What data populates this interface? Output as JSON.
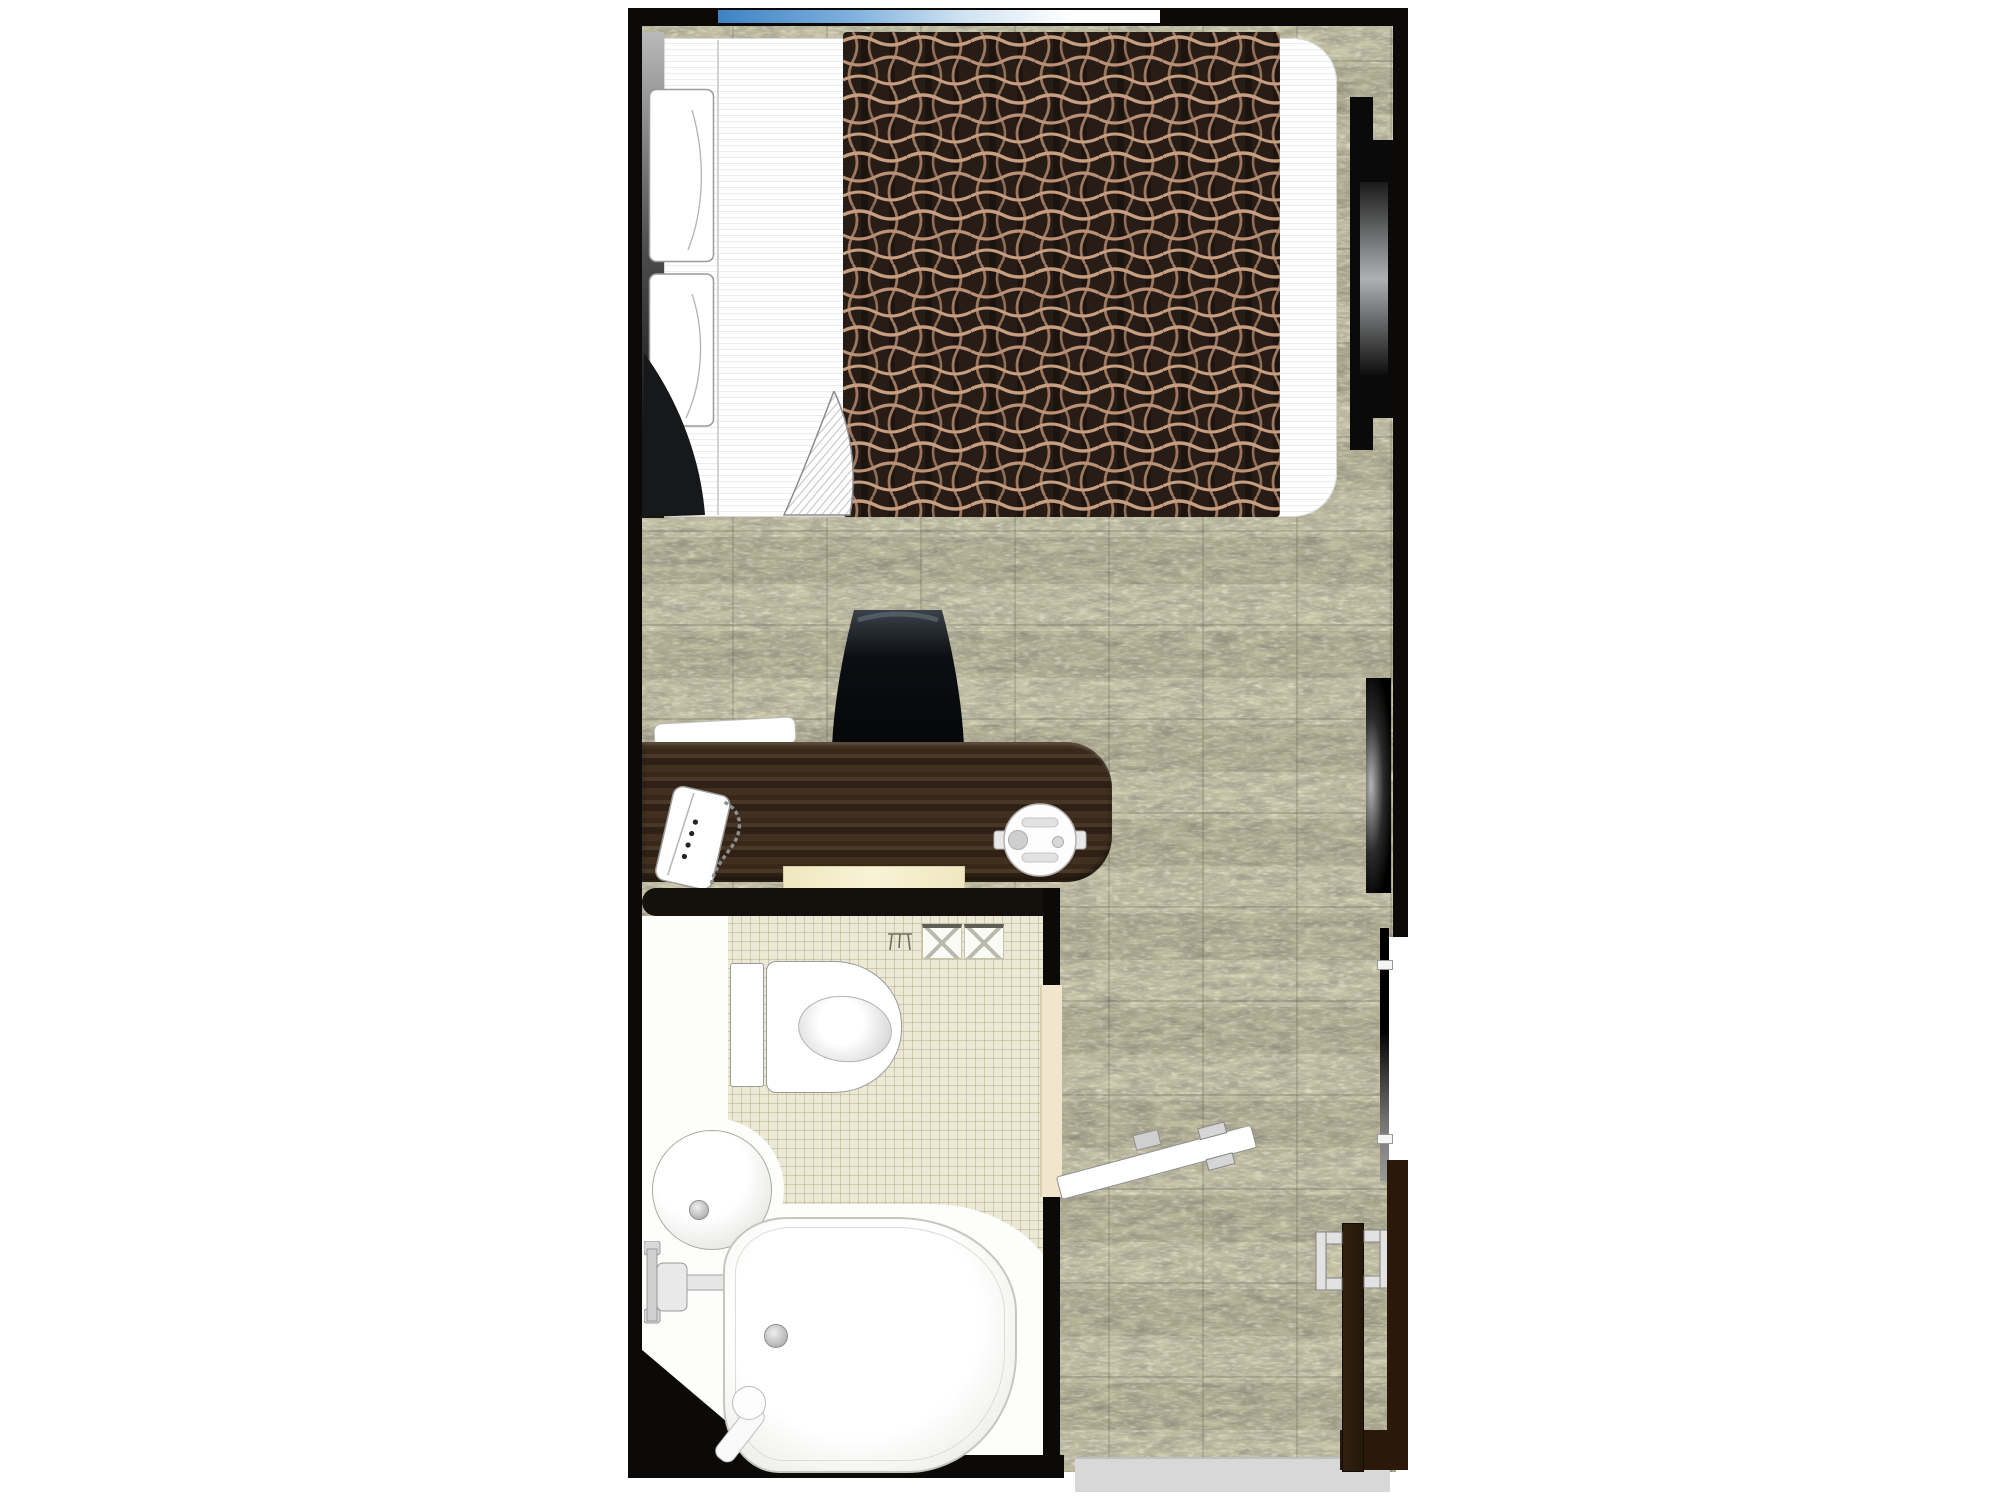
{
  "page": {
    "title": "Hotel single-room floor plan",
    "background": "#ffffff"
  },
  "plan": {
    "labels": {
      "carpet": "carpet floor",
      "window": "window",
      "bed": "single bed",
      "pillows": "pillows",
      "runner": "patterned bed runner",
      "headboard": "headboard",
      "sheet_fold": "turned-down sheet corner",
      "desk": "writing desk",
      "chair": "desk chair",
      "phone": "telephone",
      "kettle": "electric kettle",
      "tray": "desk tray",
      "shelf": "lower shelf",
      "bathroom": "unit bathroom",
      "tiles": "bathroom tile floor",
      "toilet": "toilet",
      "towels": "folded towels",
      "towel_stand": "towel stand",
      "basin": "washbasin",
      "faucet": "bath faucet",
      "bathtub": "bathtub",
      "bathroom_door": "bathroom door (open)",
      "console": "window-side console",
      "tv": "wall-mounted TV",
      "sliding_panel": "sliding panel",
      "entrance_door": "entrance door (open)",
      "door_handles": "door handles",
      "threshold": "entrance threshold"
    },
    "colors": {
      "wall_black": "#0c0a08",
      "wall_brown": "#2a190b",
      "carpet_base": "#c8c4a5",
      "carpet_dark": "#55523f",
      "tile": "#ebe9d6",
      "desk_wood": "#3a2b1c",
      "runner_base": "#281c16",
      "runner_line": "#c79e80",
      "window_blue": "#3d83c4",
      "threshold_gray": "#d8d8d8",
      "fixture_white": "#fdfdfb"
    }
  }
}
